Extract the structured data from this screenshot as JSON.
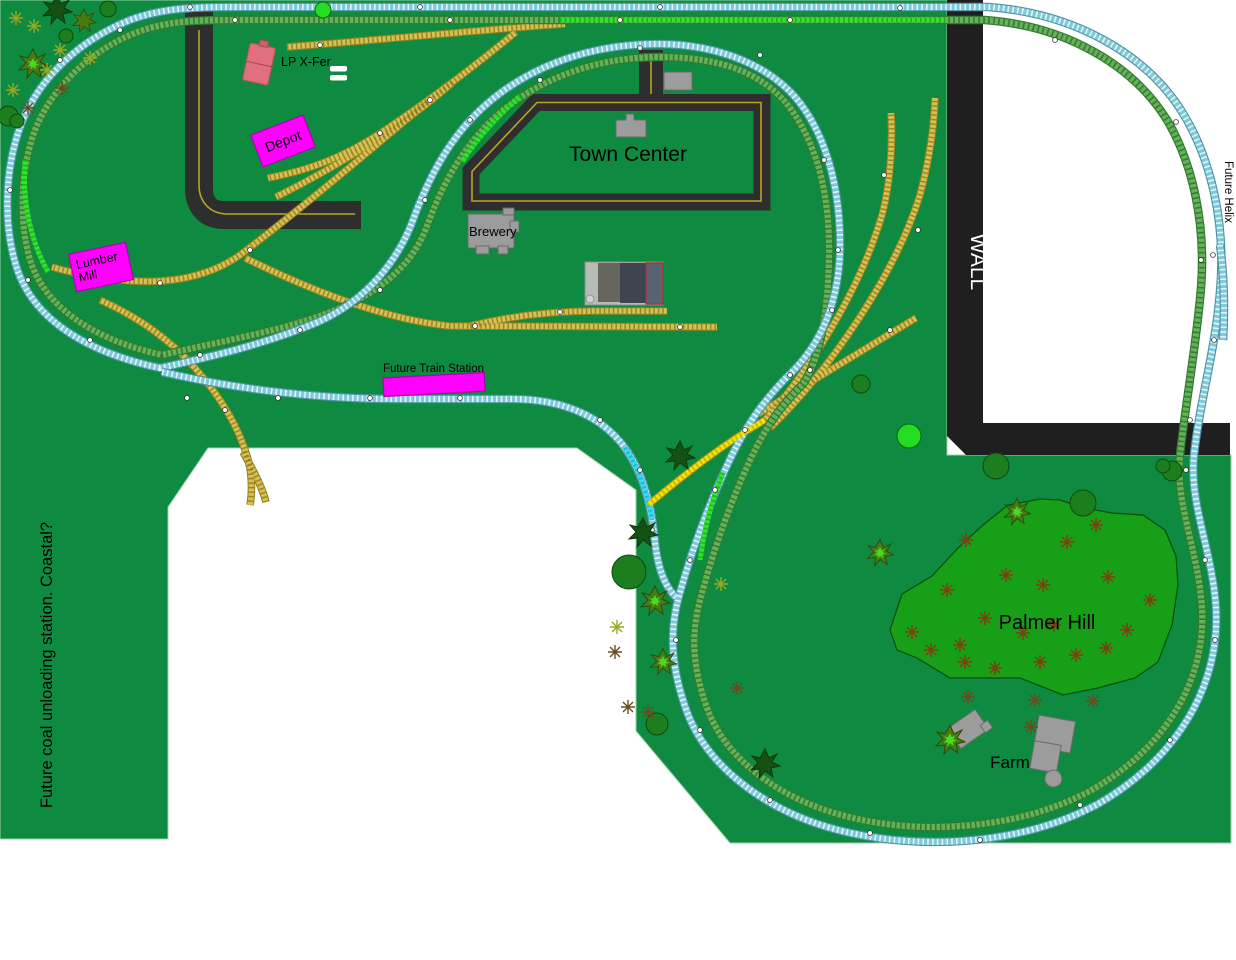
{
  "canvas": {
    "width": 1236,
    "height": 960
  },
  "labels": {
    "lp_xfer": "LP X-Fer",
    "depot": "Depot",
    "lumber_mill_1": "Lumber",
    "lumber_mill_2": "Mill",
    "brewery": "Brewery",
    "town_center": "Town Center",
    "future_train_station": "Future Train Station",
    "palmer_hill": "Palmer Hill",
    "farm": "Farm",
    "wall": "WALL",
    "future_helix": "Future Helix",
    "coal_note": "Future coal unloading station.  Coastal?"
  },
  "colors": {
    "baseboard_green": "#0e8b41",
    "hill_green": "#17a017",
    "wall_black": "#1f1f1f",
    "road_gray": "#2e2e2e",
    "road_centerline": "#b8a520",
    "track_teal": "#7ec9da",
    "track_green": "#62b356",
    "track_yellow": "#d7c050",
    "highlight_green": "#33e033",
    "highlight_cyan": "#3cd8ee",
    "highlight_yellow": "#f2e300",
    "building_magenta": "#ff00ff",
    "building_pink": "#e0707e",
    "building_gray": "#9c9c9c"
  }
}
